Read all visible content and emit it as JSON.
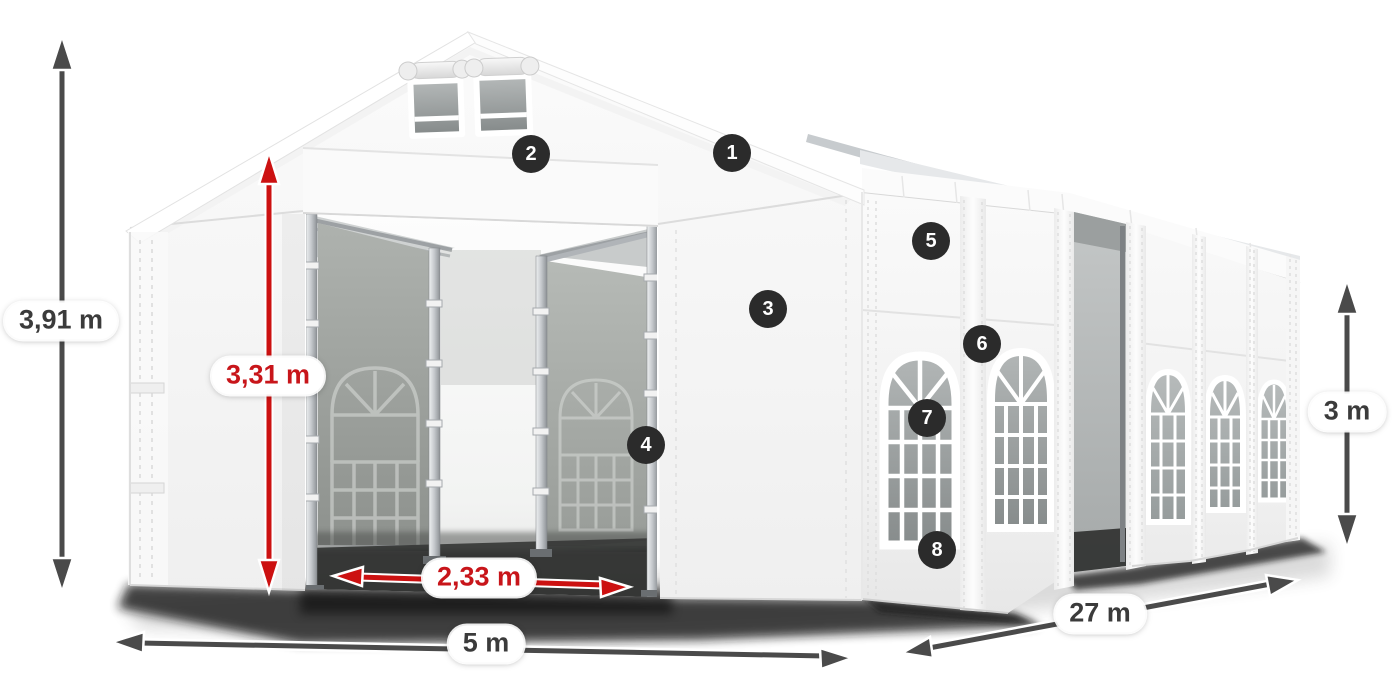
{
  "diagram": {
    "type": "product-dimension-diagram",
    "dimensions": {
      "total_height": "3,91 m",
      "entrance_height": "3,31 m",
      "entrance_width": "2,33 m",
      "width": "5 m",
      "length": "27 m",
      "side_height": "3 m"
    },
    "callouts": [
      "1",
      "2",
      "3",
      "4",
      "5",
      "6",
      "7",
      "8"
    ],
    "colors": {
      "dimension_red": "#cc1111",
      "dimension_red_text": "#c8151a",
      "dimension_gray": "#4a4a4a",
      "dimension_gray_text": "#3b3b3b",
      "badge_background": "#2b2b2b",
      "badge_text": "#ffffff",
      "background": "#ffffff"
    }
  }
}
